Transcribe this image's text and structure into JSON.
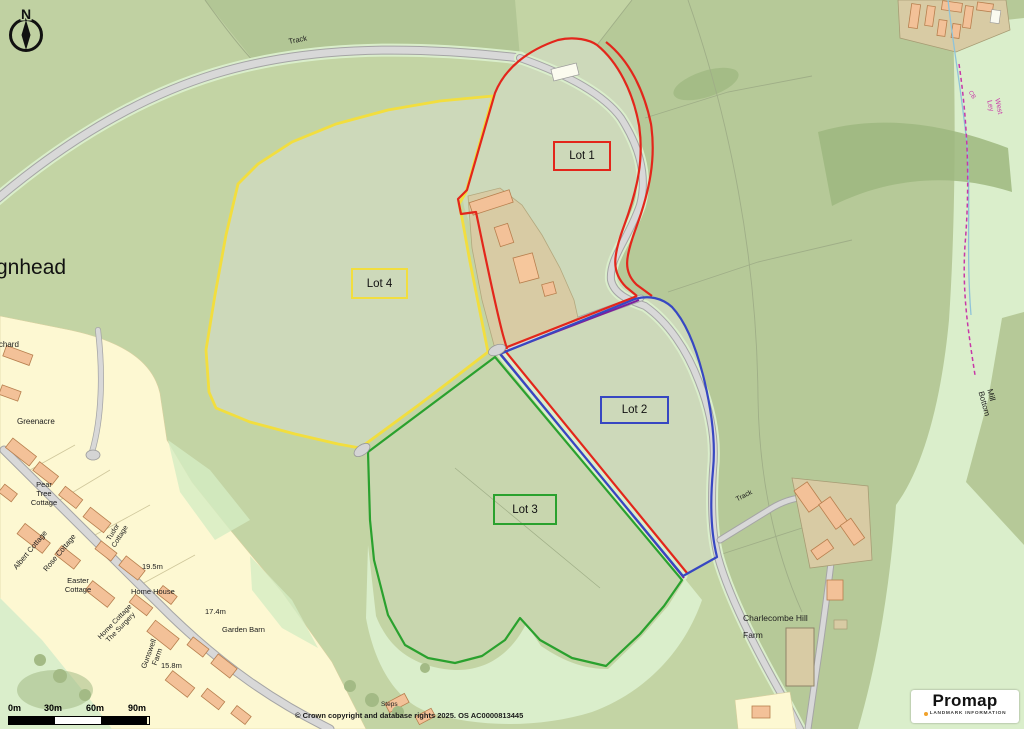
{
  "map": {
    "colors": {
      "lot1": "#e3261b",
      "lot2": "#3747c2",
      "lot3": "#2aa12e",
      "lot4": "#f2de3e",
      "purple": "#7d1f9c",
      "magenta": "#c837a8",
      "logo_dot": "#f0a22c"
    },
    "compass_letter": "N",
    "lots": [
      {
        "label": "Lot 1"
      },
      {
        "label": "Lot 2"
      },
      {
        "label": "Lot 3"
      },
      {
        "label": "Lot 4"
      }
    ],
    "labels": [
      {
        "text": "Track"
      },
      {
        "text": "gnhead"
      },
      {
        "text": "Orchard"
      },
      {
        "text": "Greenacre"
      },
      {
        "text": "Pear\nTree\nCottage"
      },
      {
        "text": "Albert Cottage"
      },
      {
        "text": "Rose Cottage"
      },
      {
        "text": "Tudor\nCottage"
      },
      {
        "text": "Easter\nCottage"
      },
      {
        "text": "19.5m"
      },
      {
        "text": "Home House"
      },
      {
        "text": "Home Cottage\nThe Surgery"
      },
      {
        "text": "17.4m"
      },
      {
        "text": "Garden Barn"
      },
      {
        "text": "Gunswell\nFarm"
      },
      {
        "text": "15.8m"
      },
      {
        "text": "Steps"
      },
      {
        "text": "Charlecombe Hill"
      },
      {
        "text": "Farm"
      },
      {
        "text": "Track"
      },
      {
        "text": "Mill Bottom"
      },
      {
        "text": "West Ley"
      },
      {
        "text": "CB"
      }
    ],
    "scale": {
      "t0": "0m",
      "t1": "30m",
      "t2": "60m",
      "t3": "90m"
    },
    "copyright": "© Crown copyright and database rights 2025. OS AC0000813445",
    "logo": {
      "brand": "Promap",
      "tagline": "LANDMARK INFORMATION"
    }
  }
}
